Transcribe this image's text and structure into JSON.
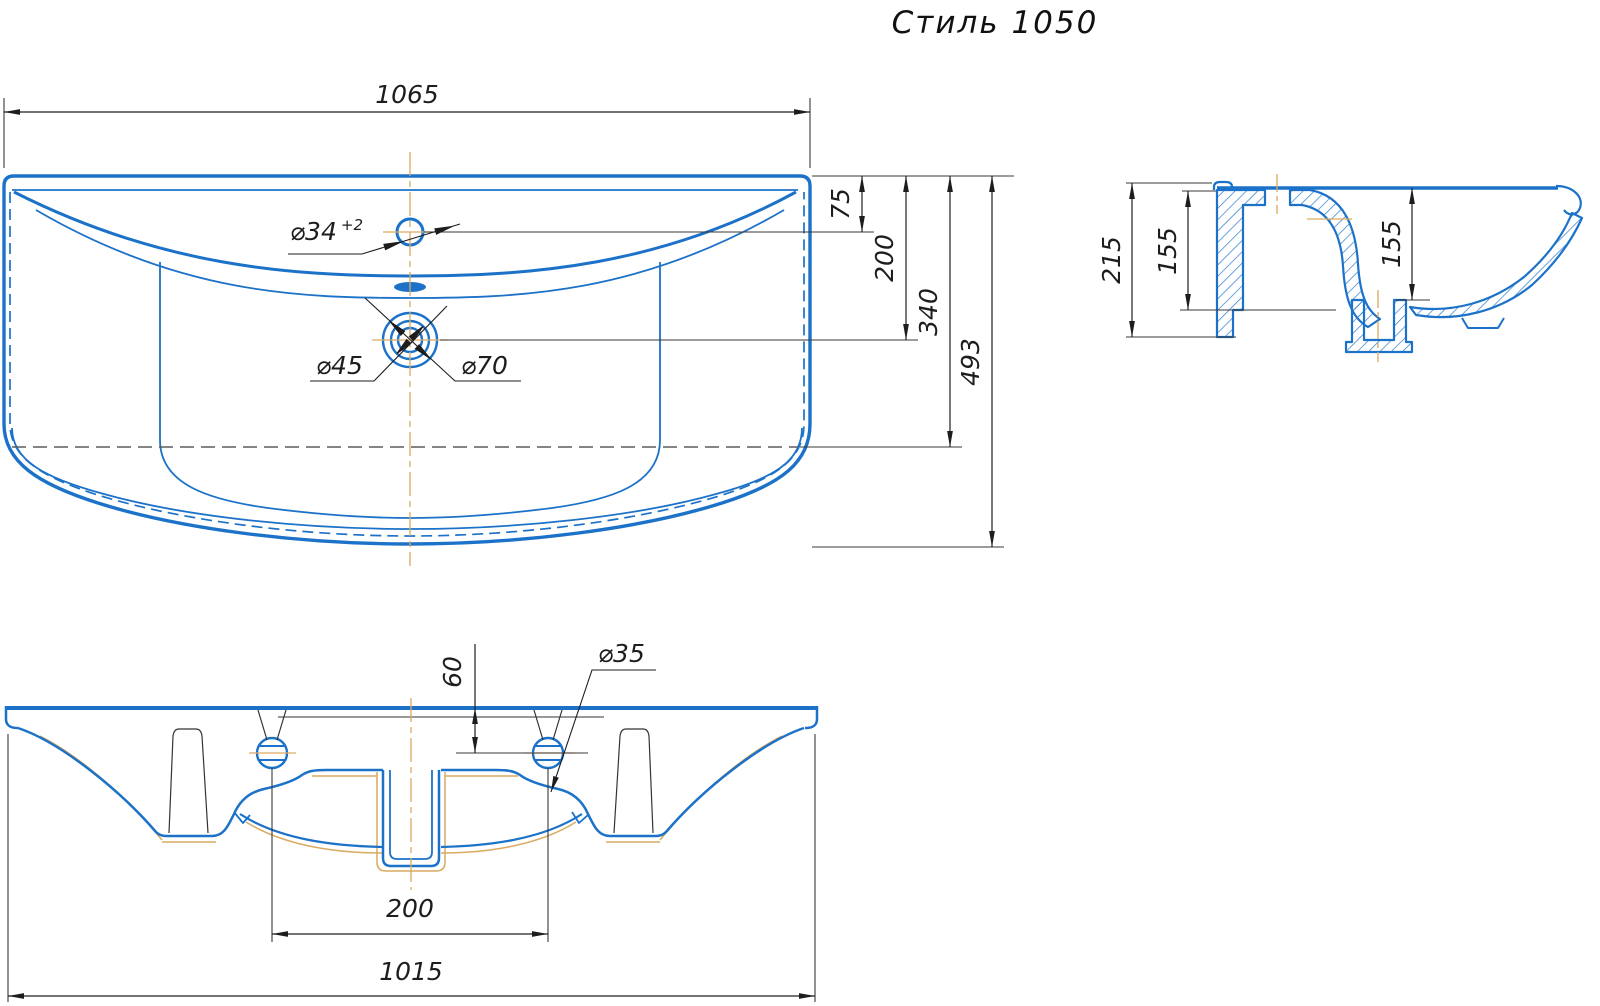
{
  "title": "Стиль 1050",
  "colors": {
    "line_blue": "#1c72c8",
    "centerline_tan": "#d9aa60",
    "dim_dark": "#1d1d1d",
    "hidden_gray": "#5d5d5d"
  },
  "plan_view": {
    "overall_width": "1065",
    "faucet_hole_dia": "⌀34",
    "faucet_hole_tol": "+2",
    "drain_inner_dia": "⌀45",
    "drain_outer_dia": "⌀70",
    "top_to_faucet": "75",
    "top_to_drain": "200",
    "top_to_hidden_edge": "340",
    "overall_depth": "493"
  },
  "section_view": {
    "total_height": "215",
    "back_inner_height": "155",
    "bowl_depth": "155"
  },
  "front_view": {
    "hole_offset_from_top": "60",
    "mount_hole_dia": "⌀35",
    "hole_spacing": "200",
    "base_width": "1015"
  }
}
